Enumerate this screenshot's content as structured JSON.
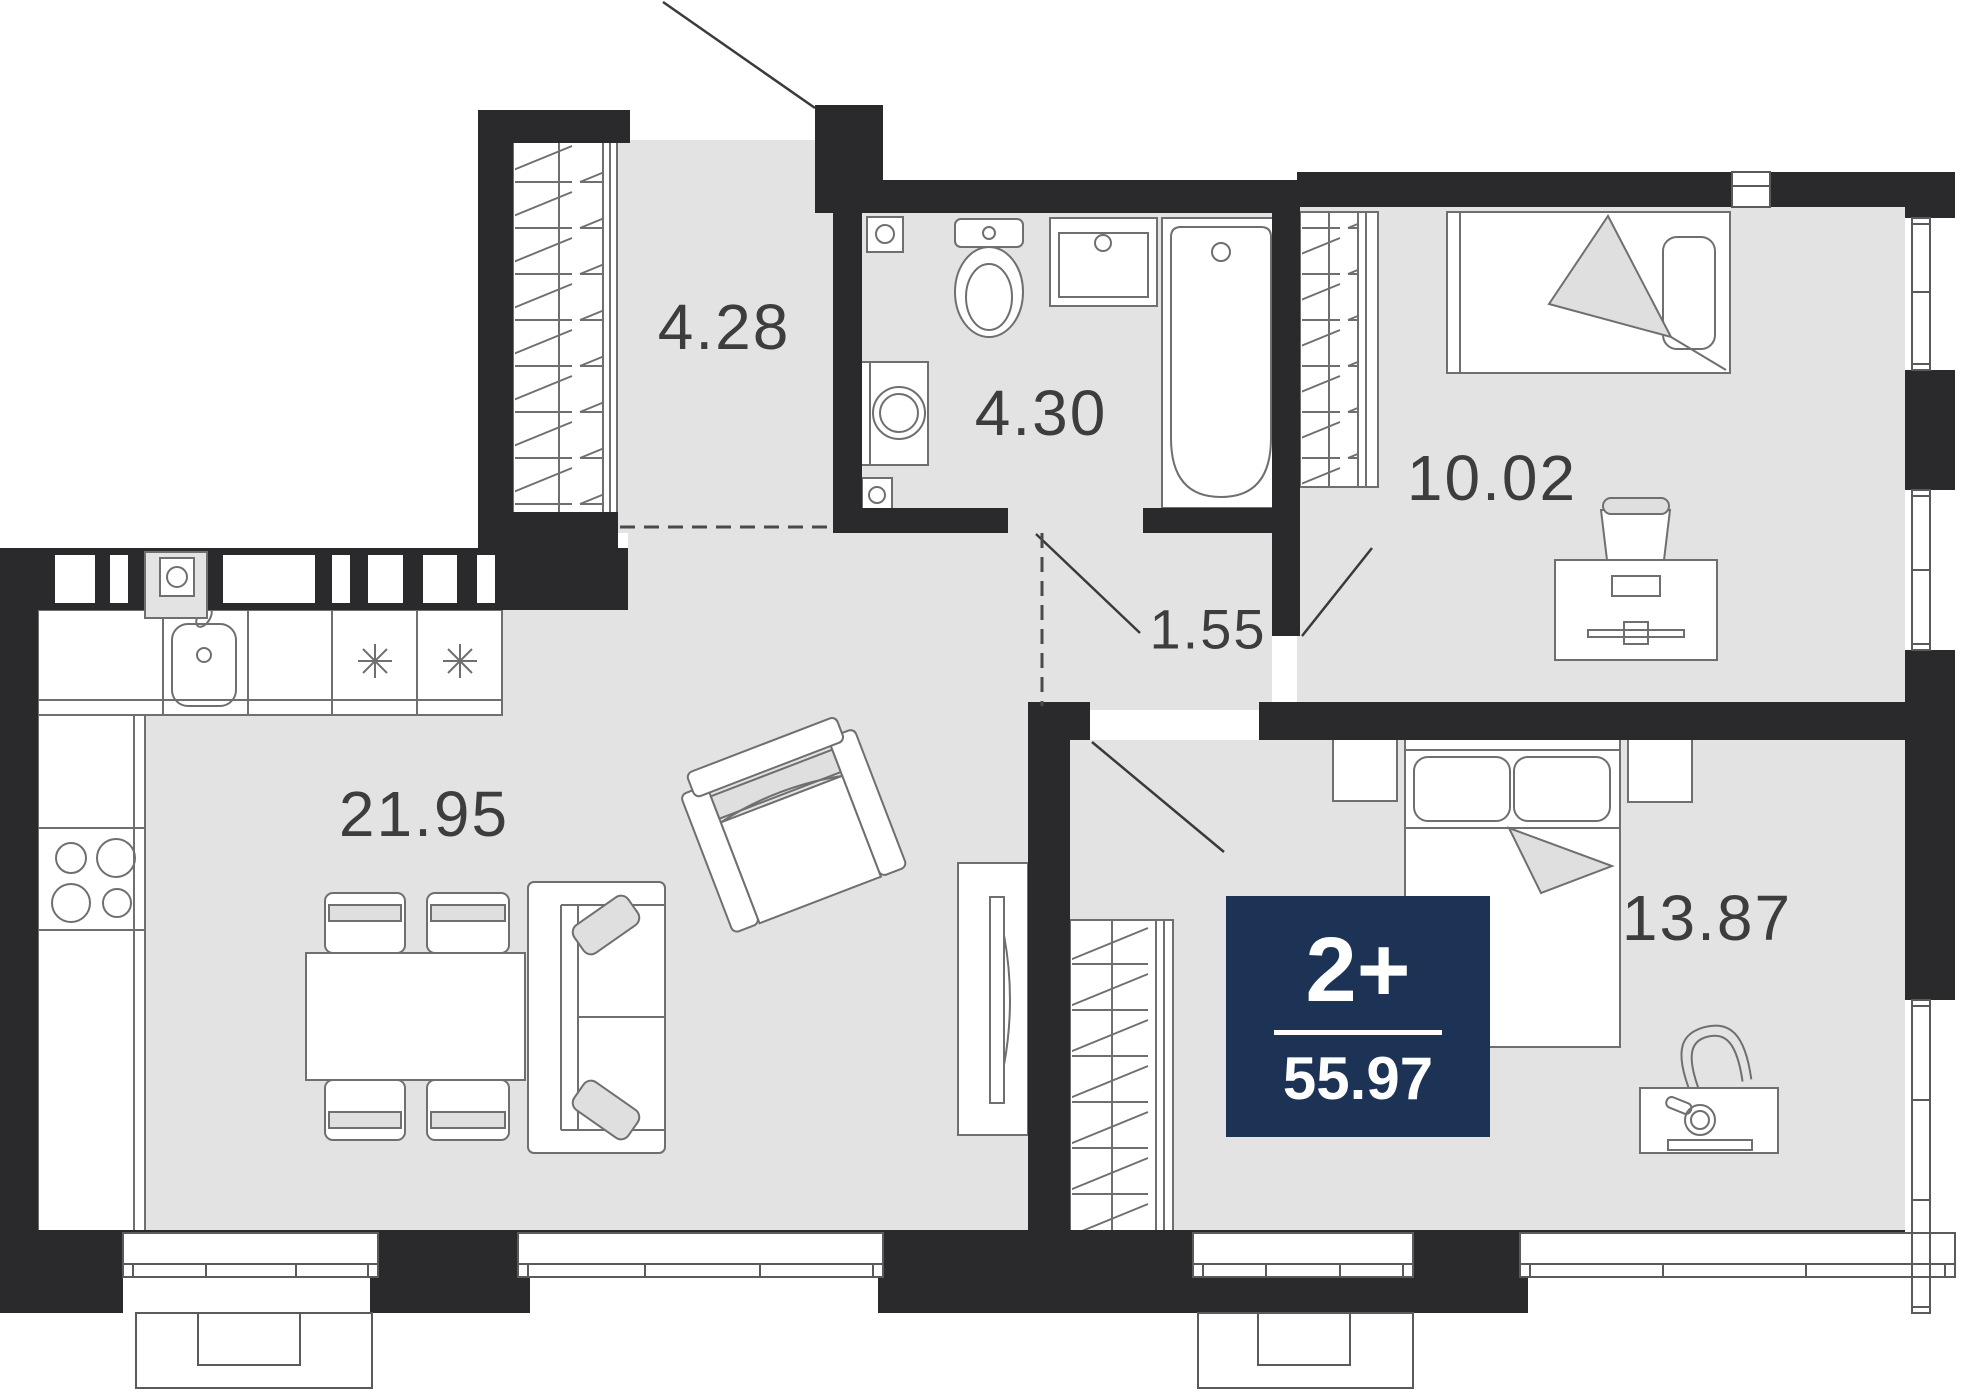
{
  "plan": {
    "badge": {
      "type": "2+",
      "area": "55.97"
    },
    "rooms": [
      {
        "id": "hall",
        "area": "4.28"
      },
      {
        "id": "bathroom",
        "area": "4.30"
      },
      {
        "id": "bedroom-1",
        "area": "10.02"
      },
      {
        "id": "corridor",
        "area": "1.55"
      },
      {
        "id": "kitchen-living",
        "area": "21.95"
      },
      {
        "id": "bedroom-2",
        "area": "13.87"
      }
    ],
    "colors": {
      "wall": "#2a2a2c",
      "floor": "#e3e3e4",
      "badge_bg": "#1d3355",
      "badge_text": "#ffffff",
      "line": "#6f6f6f",
      "label": "#3d3d3d",
      "accent": "#dfdfdf"
    }
  }
}
